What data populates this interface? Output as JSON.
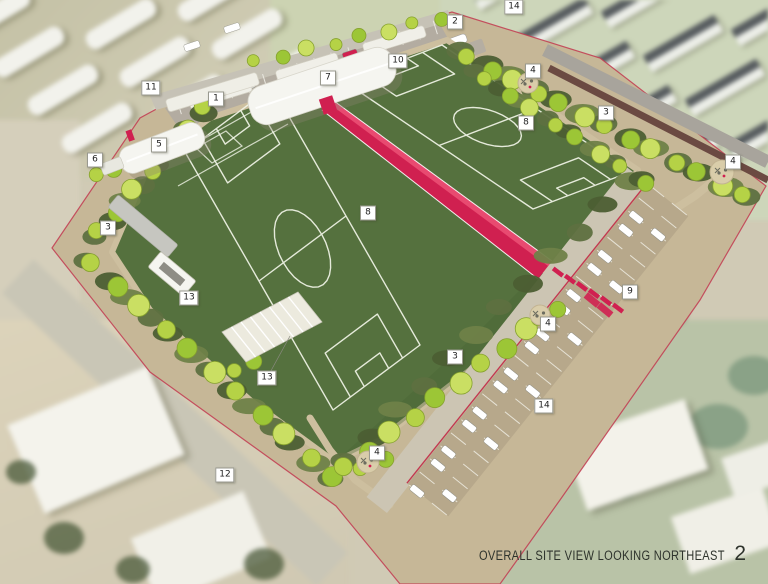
{
  "view": {
    "caption": "OVERALL SITE VIEW LOOKING NORTHEAST",
    "page_number": "2"
  },
  "callouts": [
    {
      "n": "11",
      "x": 151,
      "y": 88
    },
    {
      "n": "1",
      "x": 216,
      "y": 99
    },
    {
      "n": "7",
      "x": 328,
      "y": 78
    },
    {
      "n": "10",
      "x": 398,
      "y": 61
    },
    {
      "n": "2",
      "x": 455,
      "y": 22
    },
    {
      "n": "14",
      "x": 514,
      "y": 7
    },
    {
      "n": "4",
      "x": 533,
      "y": 71
    },
    {
      "n": "3",
      "x": 606,
      "y": 113
    },
    {
      "n": "4",
      "x": 733,
      "y": 162
    },
    {
      "n": "5",
      "x": 159,
      "y": 145
    },
    {
      "n": "6",
      "x": 95,
      "y": 160
    },
    {
      "n": "3",
      "x": 108,
      "y": 228
    },
    {
      "n": "8",
      "x": 368,
      "y": 213
    },
    {
      "n": "8",
      "x": 526,
      "y": 123
    },
    {
      "n": "9",
      "x": 630,
      "y": 292
    },
    {
      "n": "4",
      "x": 548,
      "y": 324
    },
    {
      "n": "13",
      "x": 189,
      "y": 298
    },
    {
      "n": "13",
      "x": 267,
      "y": 378
    },
    {
      "n": "3",
      "x": 455,
      "y": 357
    },
    {
      "n": "14",
      "x": 544,
      "y": 406
    },
    {
      "n": "12",
      "x": 225,
      "y": 475
    },
    {
      "n": "4",
      "x": 377,
      "y": 453
    }
  ],
  "colors": {
    "field_green": "#55713e",
    "field_green_dark": "#496334",
    "field_line": "#f2f5e8",
    "promenade_red": "#d02050",
    "promenade_red_light": "#e84a70",
    "tree_green_1": "#b5d246",
    "tree_green_2": "#9cc636",
    "tree_green_3": "#cadf63",
    "shrub_green": "#5e7040",
    "shrub_green_dark": "#4c5e33",
    "path_tan": "#cdbf9f",
    "platform_tan": "#c6b797",
    "parking_tan": "#b7a88b",
    "asphalt_gray": "#b3aca1",
    "road_tan": "#ccc5b3",
    "building_white": "#f5f5f0",
    "building_shadow": "#8a8570",
    "roof_gray": "#585d60",
    "wall_brown": "#6b4a42",
    "property_red": "#c23a50",
    "plaza_tan": "#d9cdaa",
    "caption_color": "#2e332c",
    "label_bg": "#ffffff",
    "label_border": "#99998f",
    "label_text": "#222222"
  }
}
